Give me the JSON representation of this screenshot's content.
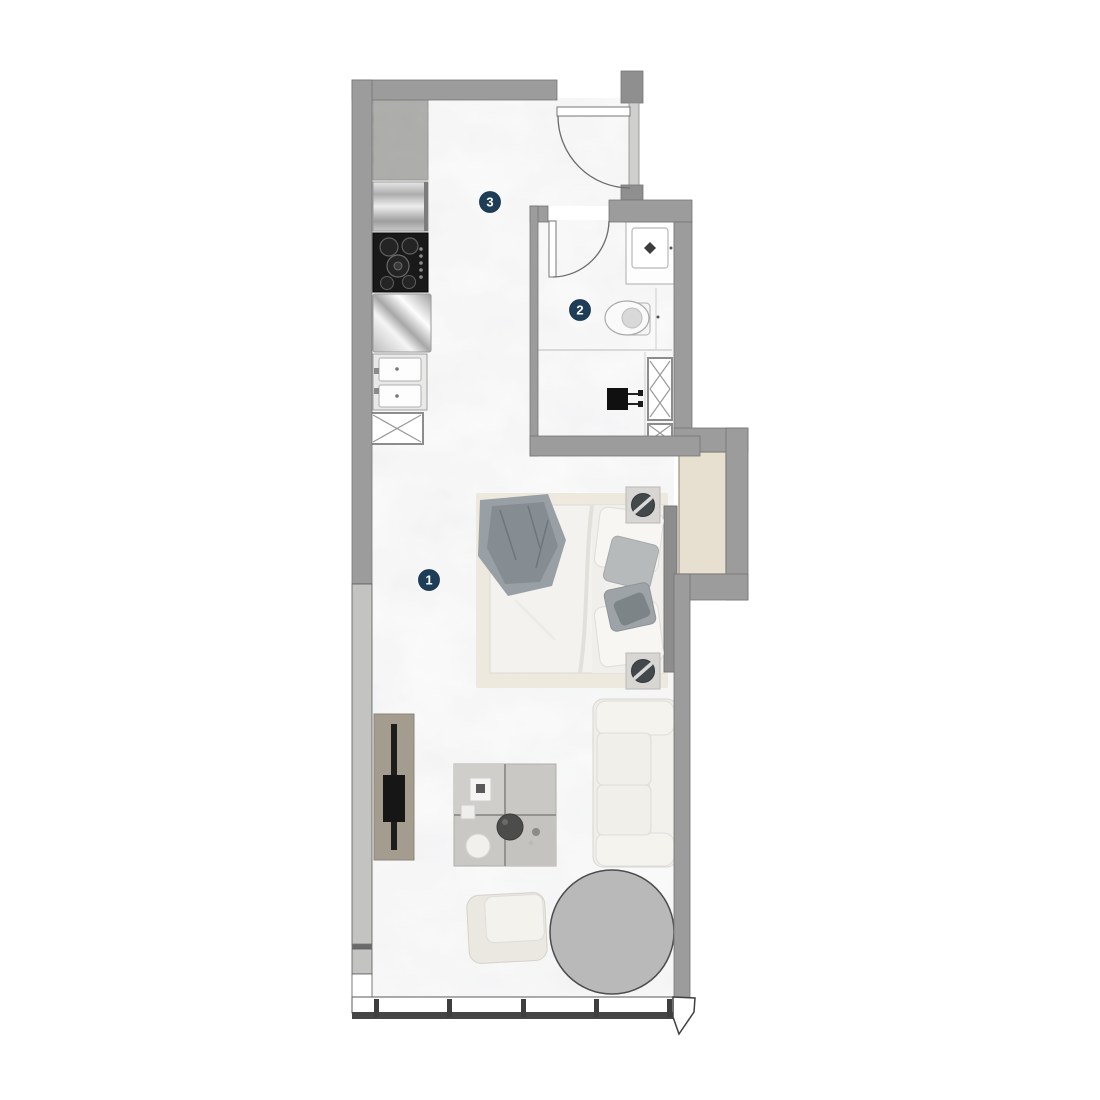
{
  "plan": {
    "type": "studio-apartment-floor-plan",
    "rooms": [
      {
        "number": "1"
      },
      {
        "number": "2"
      },
      {
        "number": "3"
      }
    ],
    "colors": {
      "wall": "#9c9c9c",
      "wall_dark": "#8f8f8f",
      "wall_outline": "#757575",
      "window_glass": "#c3c3c1",
      "window_frame_dark": "#454545",
      "label_badge": "#1e3e57",
      "label_text": "#ffffff",
      "niche_floor": "#e7e0d0",
      "round_table": "#b9b9b9",
      "cooktop": "#191919",
      "sofa": "#efeee8",
      "bed_throw": "#98a0a5",
      "bed_rug": "#efe8dc",
      "tv_console": "#a49d8f",
      "coffee_table": "#c9c8c5"
    },
    "fixtures": [
      "fridge-counter",
      "oven",
      "cooktop",
      "steel-counter",
      "double-sink",
      "vent-shaft",
      "entry-door",
      "bathroom-door",
      "vanity-sink",
      "toilet",
      "washing-machine",
      "bed",
      "nightstand",
      "table-lamp",
      "tv-console",
      "coffee-table",
      "sofa",
      "armchair",
      "round-table",
      "window-wall"
    ]
  }
}
